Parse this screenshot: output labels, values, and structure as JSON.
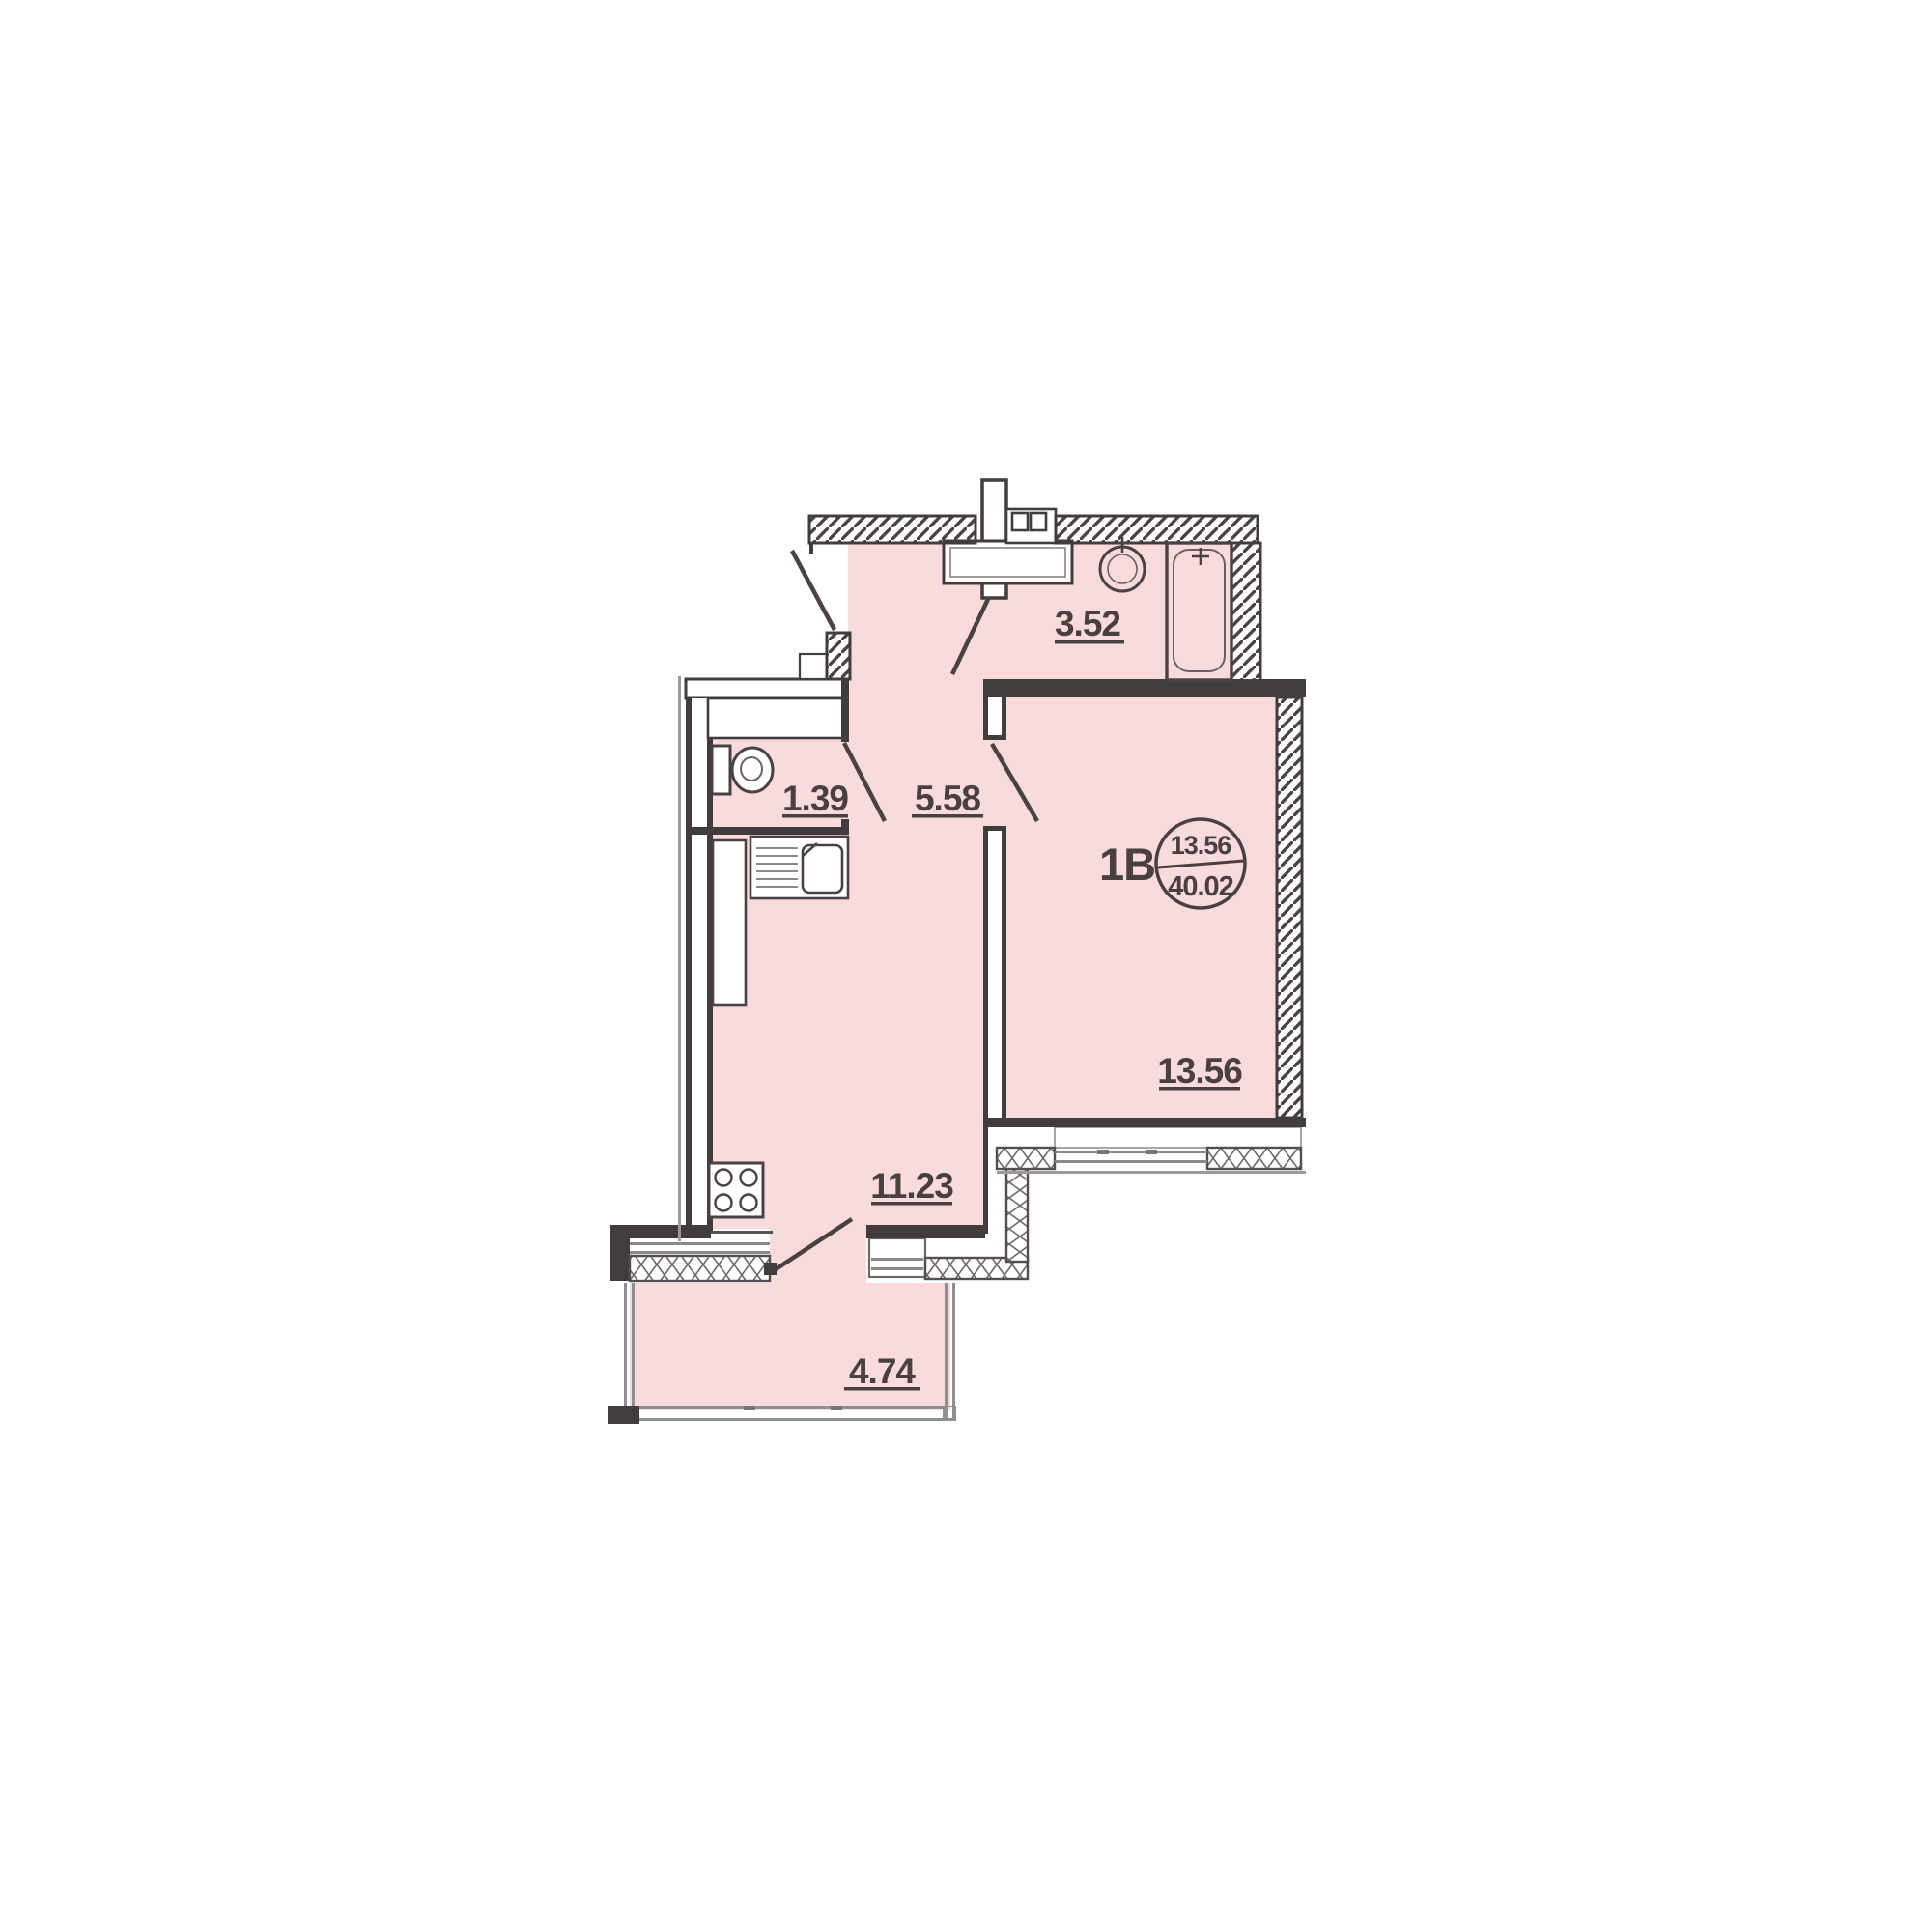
{
  "title": "Apartment floor plan",
  "unit": {
    "code": "1B",
    "area_living": "13.56",
    "area_total": "40.02"
  },
  "rooms": {
    "bathroom": {
      "area": "3.52"
    },
    "wc": {
      "area": "1.39"
    },
    "hallway": {
      "area": "5.58"
    },
    "kitchen": {
      "area": "11.23"
    },
    "living_room": {
      "area": "13.56"
    },
    "balcony": {
      "area": "4.74"
    }
  },
  "colors": {
    "room_fill": "#f9dadd",
    "wall": "#423c3c",
    "label": "#4a4040",
    "line_gray": "#8f8f8f"
  }
}
